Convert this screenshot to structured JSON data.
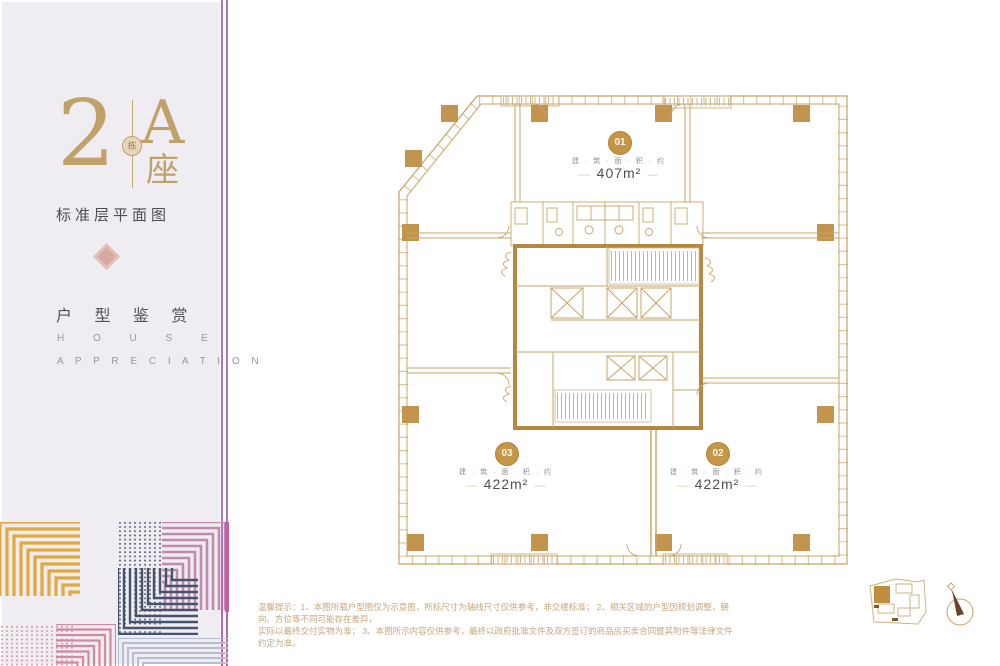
{
  "sidebar": {
    "building_number": "2",
    "building_badge": "栋",
    "block_letter": "A",
    "block_char": "座",
    "subtitle": "标准层平面图",
    "section_cn": "户 型 鉴 赏",
    "section_en_1": "H O U S E",
    "section_en_2": "A P P R E C I A T I O N"
  },
  "plan": {
    "units": [
      {
        "id": "01",
        "label": "建 · 筑 · 面 · 积 · 约",
        "area": "407m²"
      },
      {
        "id": "02",
        "label": "建 · 筑 · 面 · 积 · 约",
        "area": "422m²"
      },
      {
        "id": "03",
        "label": "建 · 筑 · 面 · 积 · 约",
        "area": "422m²"
      }
    ],
    "dash": "—"
  },
  "footer": {
    "line1": "温馨提示：1、本图所载户型图仅为示意图，所标尺寸为轴线尺寸仅供参考，非交楼标准；  2、相关区域的户型因规划调整，朝向、方位等不同可能存在差异，",
    "line2": "实际以最终交付实物为准；  3、本图所示内容仅供参考，最终以政府批准文件及双方签订的商品房买卖合同暨其附件等法律文件约定为准。"
  },
  "colors": {
    "panel_bg": "#efedf2",
    "panel_border_purple": "#aa78bf",
    "title_gold": "#c0a169",
    "plan_line": "#c8a365",
    "plan_tick": "#dcc89e",
    "plan_column": "#c2944e",
    "plan_core_wall": "#b6883f",
    "plan_hatch": "#cfb98c",
    "unit_circle": "#c59647",
    "ornament_pink": "#d9a9a1",
    "deco_gold": "#e2a93e",
    "deco_navy": "#46536e",
    "deco_mauve": "#c08cab",
    "deco_rose": "#d08ba0",
    "deco_lavender": "#b7bdd1",
    "deco_magenta": "#c75da5",
    "disclaimer_text": "#c3a77e"
  }
}
